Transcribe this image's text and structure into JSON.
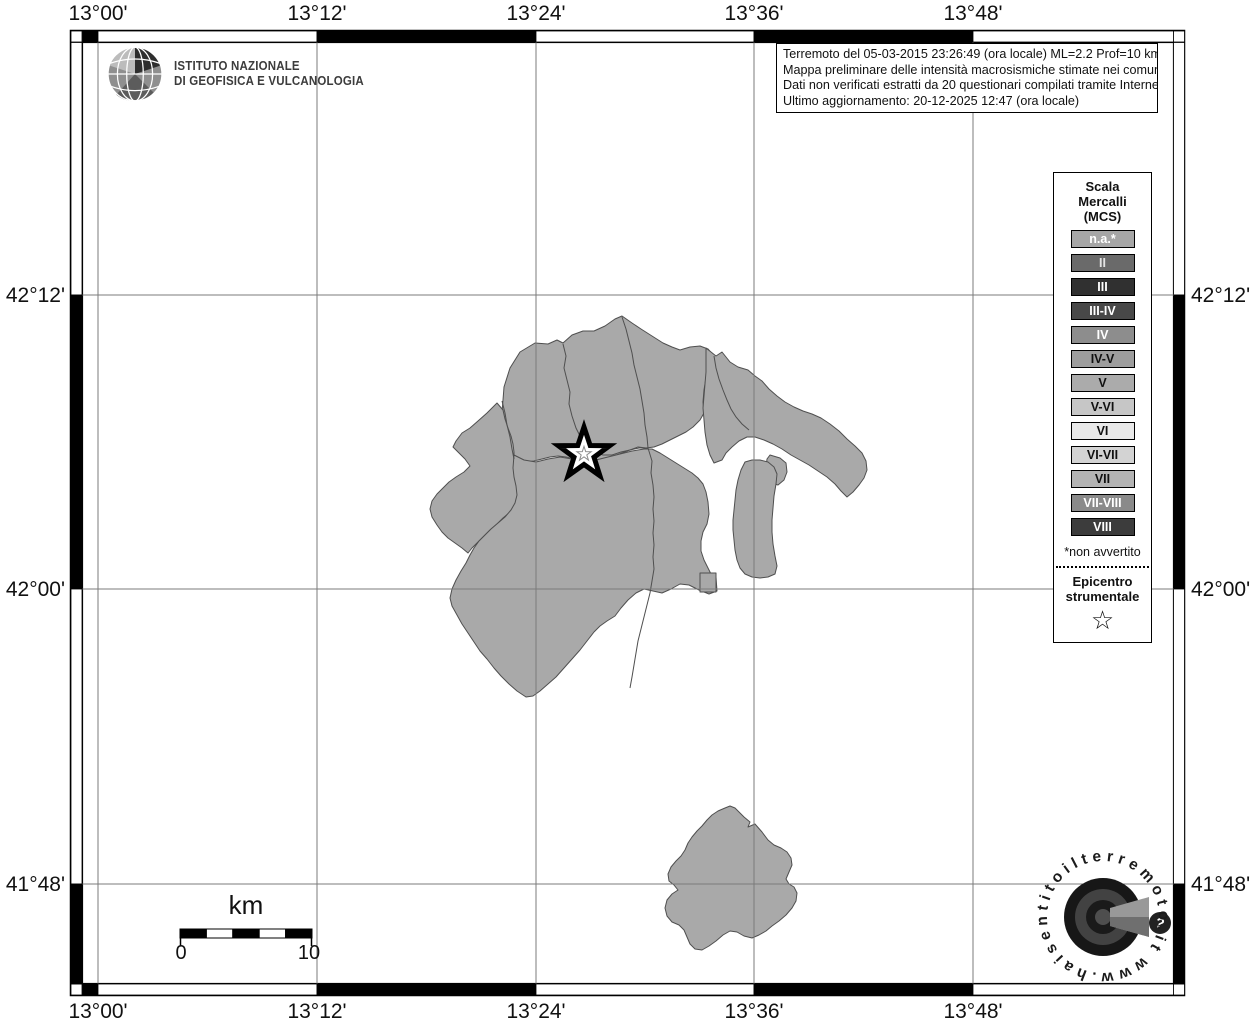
{
  "header": {
    "ingv_line1": "ISTITUTO NAZIONALE",
    "ingv_line2": "DI GEOFISICA E VULCANOLOGIA"
  },
  "info_box": {
    "line1": "Terremoto del 05-03-2015 23:26:49 (ora locale) ML=2.2 Prof=10 km",
    "line2": "Mappa preliminare delle intensità macrosismiche stimate nei comuni",
    "line3": "Dati non verificati estratti da 20 questionari compilati tramite Internet.",
    "line4": "Ultimo aggiornamento: 20-12-2025 12:47 (ora locale)"
  },
  "legend": {
    "title_line1": "Scala",
    "title_line2": "Mercalli",
    "title_line3": "(MCS)",
    "items": [
      {
        "label": "n.a.*",
        "bg": "#a6a6a6",
        "fg": "#ffffff"
      },
      {
        "label": "II",
        "bg": "#6a6a6a",
        "fg": "#e3e3e3"
      },
      {
        "label": "III",
        "bg": "#303030",
        "fg": "#ffffff"
      },
      {
        "label": "III-IV",
        "bg": "#484848",
        "fg": "#ffffff"
      },
      {
        "label": "IV",
        "bg": "#8d8d8d",
        "fg": "#ffffff"
      },
      {
        "label": "IV-V",
        "bg": "#9d9d9d",
        "fg": "#111111"
      },
      {
        "label": "V",
        "bg": "#ababab",
        "fg": "#111111"
      },
      {
        "label": "V-VI",
        "bg": "#c6c6c6",
        "fg": "#111111"
      },
      {
        "label": "VI",
        "bg": "#e9e9e9",
        "fg": "#111111"
      },
      {
        "label": "VI-VII",
        "bg": "#d3d3d3",
        "fg": "#111111"
      },
      {
        "label": "VII",
        "bg": "#b3b3b3",
        "fg": "#111111"
      },
      {
        "label": "VII-VIII",
        "bg": "#8a8a8a",
        "fg": "#ffffff"
      },
      {
        "label": "VIII",
        "bg": "#3c3c3c",
        "fg": "#ffffff"
      }
    ],
    "footnote": "*non avvertito",
    "epicenter_line1": "Epicentro",
    "epicenter_line2": "strumentale"
  },
  "axes": {
    "top": [
      "13°00'",
      "13°12'",
      "13°24'",
      "13°36'",
      "13°48'"
    ],
    "bottom": [
      "13°00'",
      "13°12'",
      "13°24'",
      "13°36'",
      "13°48'"
    ],
    "left": [
      "42°12'",
      "42°00'",
      "41°48'"
    ],
    "right": [
      "42°12'",
      "42°00'",
      "41°48'"
    ]
  },
  "scale_bar": {
    "unit": "km",
    "start": "0",
    "end": "10"
  },
  "watermark": {
    "circular_text": "www.haisentitoilterremoto.it",
    "question_mark": "?"
  },
  "colors": {
    "municipality_fill": "#a9a9a9",
    "municipality_border": "#4f4f4f",
    "gridline": "#7b7b7b",
    "frame": "#000000"
  }
}
